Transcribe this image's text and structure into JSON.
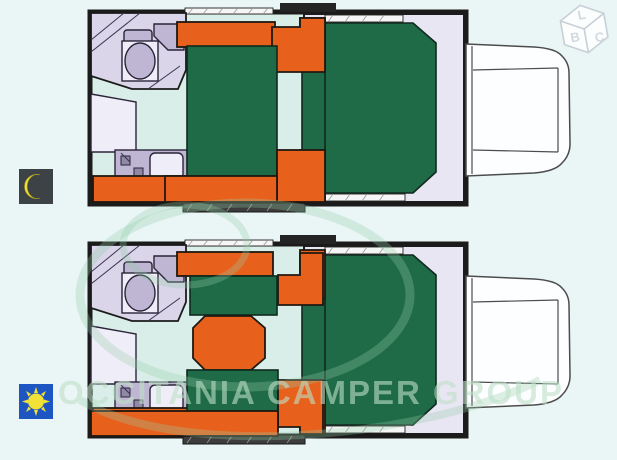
{
  "watermark": {
    "text": "OCCITANIA CAMPER GROUP",
    "color": "#bee0c8"
  },
  "logo": {
    "letters": {
      "top": "L",
      "left": "B",
      "right": "C"
    }
  },
  "legend": {
    "night": {
      "symbol": "moon",
      "tile_color": "#3d4247",
      "symbol_color": "#f2e136"
    },
    "day": {
      "symbol": "sun",
      "tile_color": "#1d55c2",
      "symbol_color": "#f2e136"
    }
  },
  "plans": [
    {
      "id": "night-layout",
      "mode": "night",
      "description_parts": [
        "bathroom",
        "wardrobe",
        "kitchen",
        "dinette-converted-to-bed",
        "cab-over-double-bed",
        "truck-cab"
      ]
    },
    {
      "id": "day-layout",
      "mode": "day",
      "description_parts": [
        "bathroom",
        "wardrobe",
        "kitchen",
        "dinette-with-table",
        "cab-over-double-bed",
        "truck-cab"
      ]
    }
  ],
  "colors": {
    "page_bg": "#eaf5f6",
    "furniture_orange": "#e8611c",
    "bed_green": "#1f6b48",
    "floor": "#d9eee9",
    "bathroom_floor": "#dad5e9",
    "platform": "#e9e6f3",
    "fixture_gray": "#beb6d2",
    "wall": "#1b1b1b",
    "night_tile": "#3d4247",
    "day_tile": "#1d55c2"
  }
}
